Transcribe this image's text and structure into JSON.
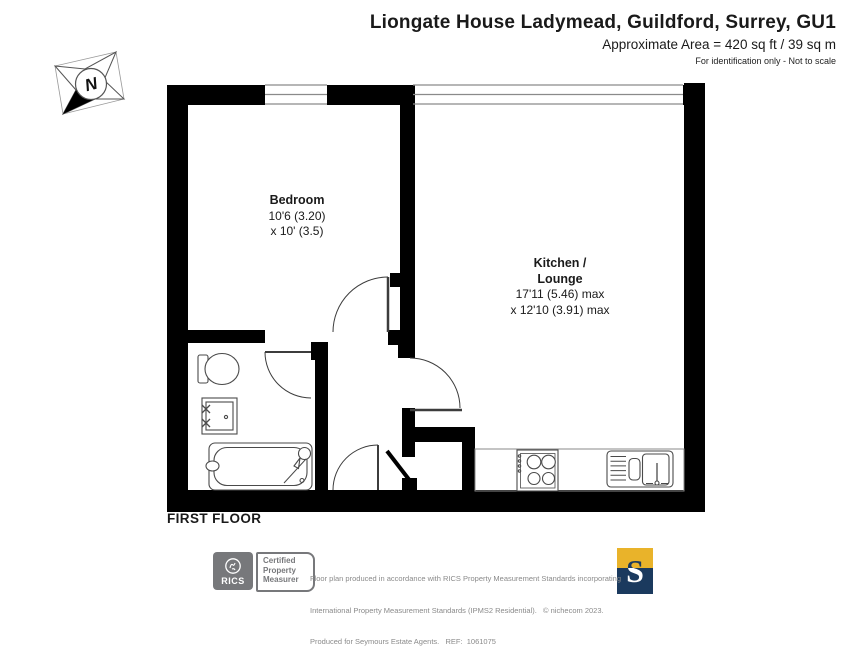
{
  "header": {
    "title": "Liongate House Ladymead, Guildford, Surrey, GU1",
    "area_line": "Approximate Area = 420 sq ft / 39 sq m",
    "note_line": "For identification only - Not to scale"
  },
  "compass": {
    "north_label": "N"
  },
  "rooms": {
    "bedroom": {
      "name": "Bedroom",
      "dims_line1": "10'6 (3.20)",
      "dims_line2": "x 10' (3.5)"
    },
    "kitchen_lounge": {
      "name_line1": "Kitchen /",
      "name_line2": "Lounge",
      "dims_line1": "17'11 (5.46) max",
      "dims_line2": "x 12'10 (3.91) max"
    }
  },
  "floor_label": "FIRST FLOOR",
  "footer": {
    "rics": {
      "brand": "RICS",
      "cert_line1": "Certified",
      "cert_line2": "Property",
      "cert_line3": "Measurer"
    },
    "line1": "Floor plan produced in accordance with RICS Property Measurement Standards incorporating",
    "line2": "International Property Measurement Standards (IPMS2 Residential).   © nichecom 2023.",
    "line3": "Produced for Seymours Estate Agents.   REF:  1061075",
    "logo_letter": "S"
  },
  "colors": {
    "wall": "#000000",
    "gold": "#e9b32a",
    "navy": "#1b3a5e",
    "grey": "#77787b"
  }
}
